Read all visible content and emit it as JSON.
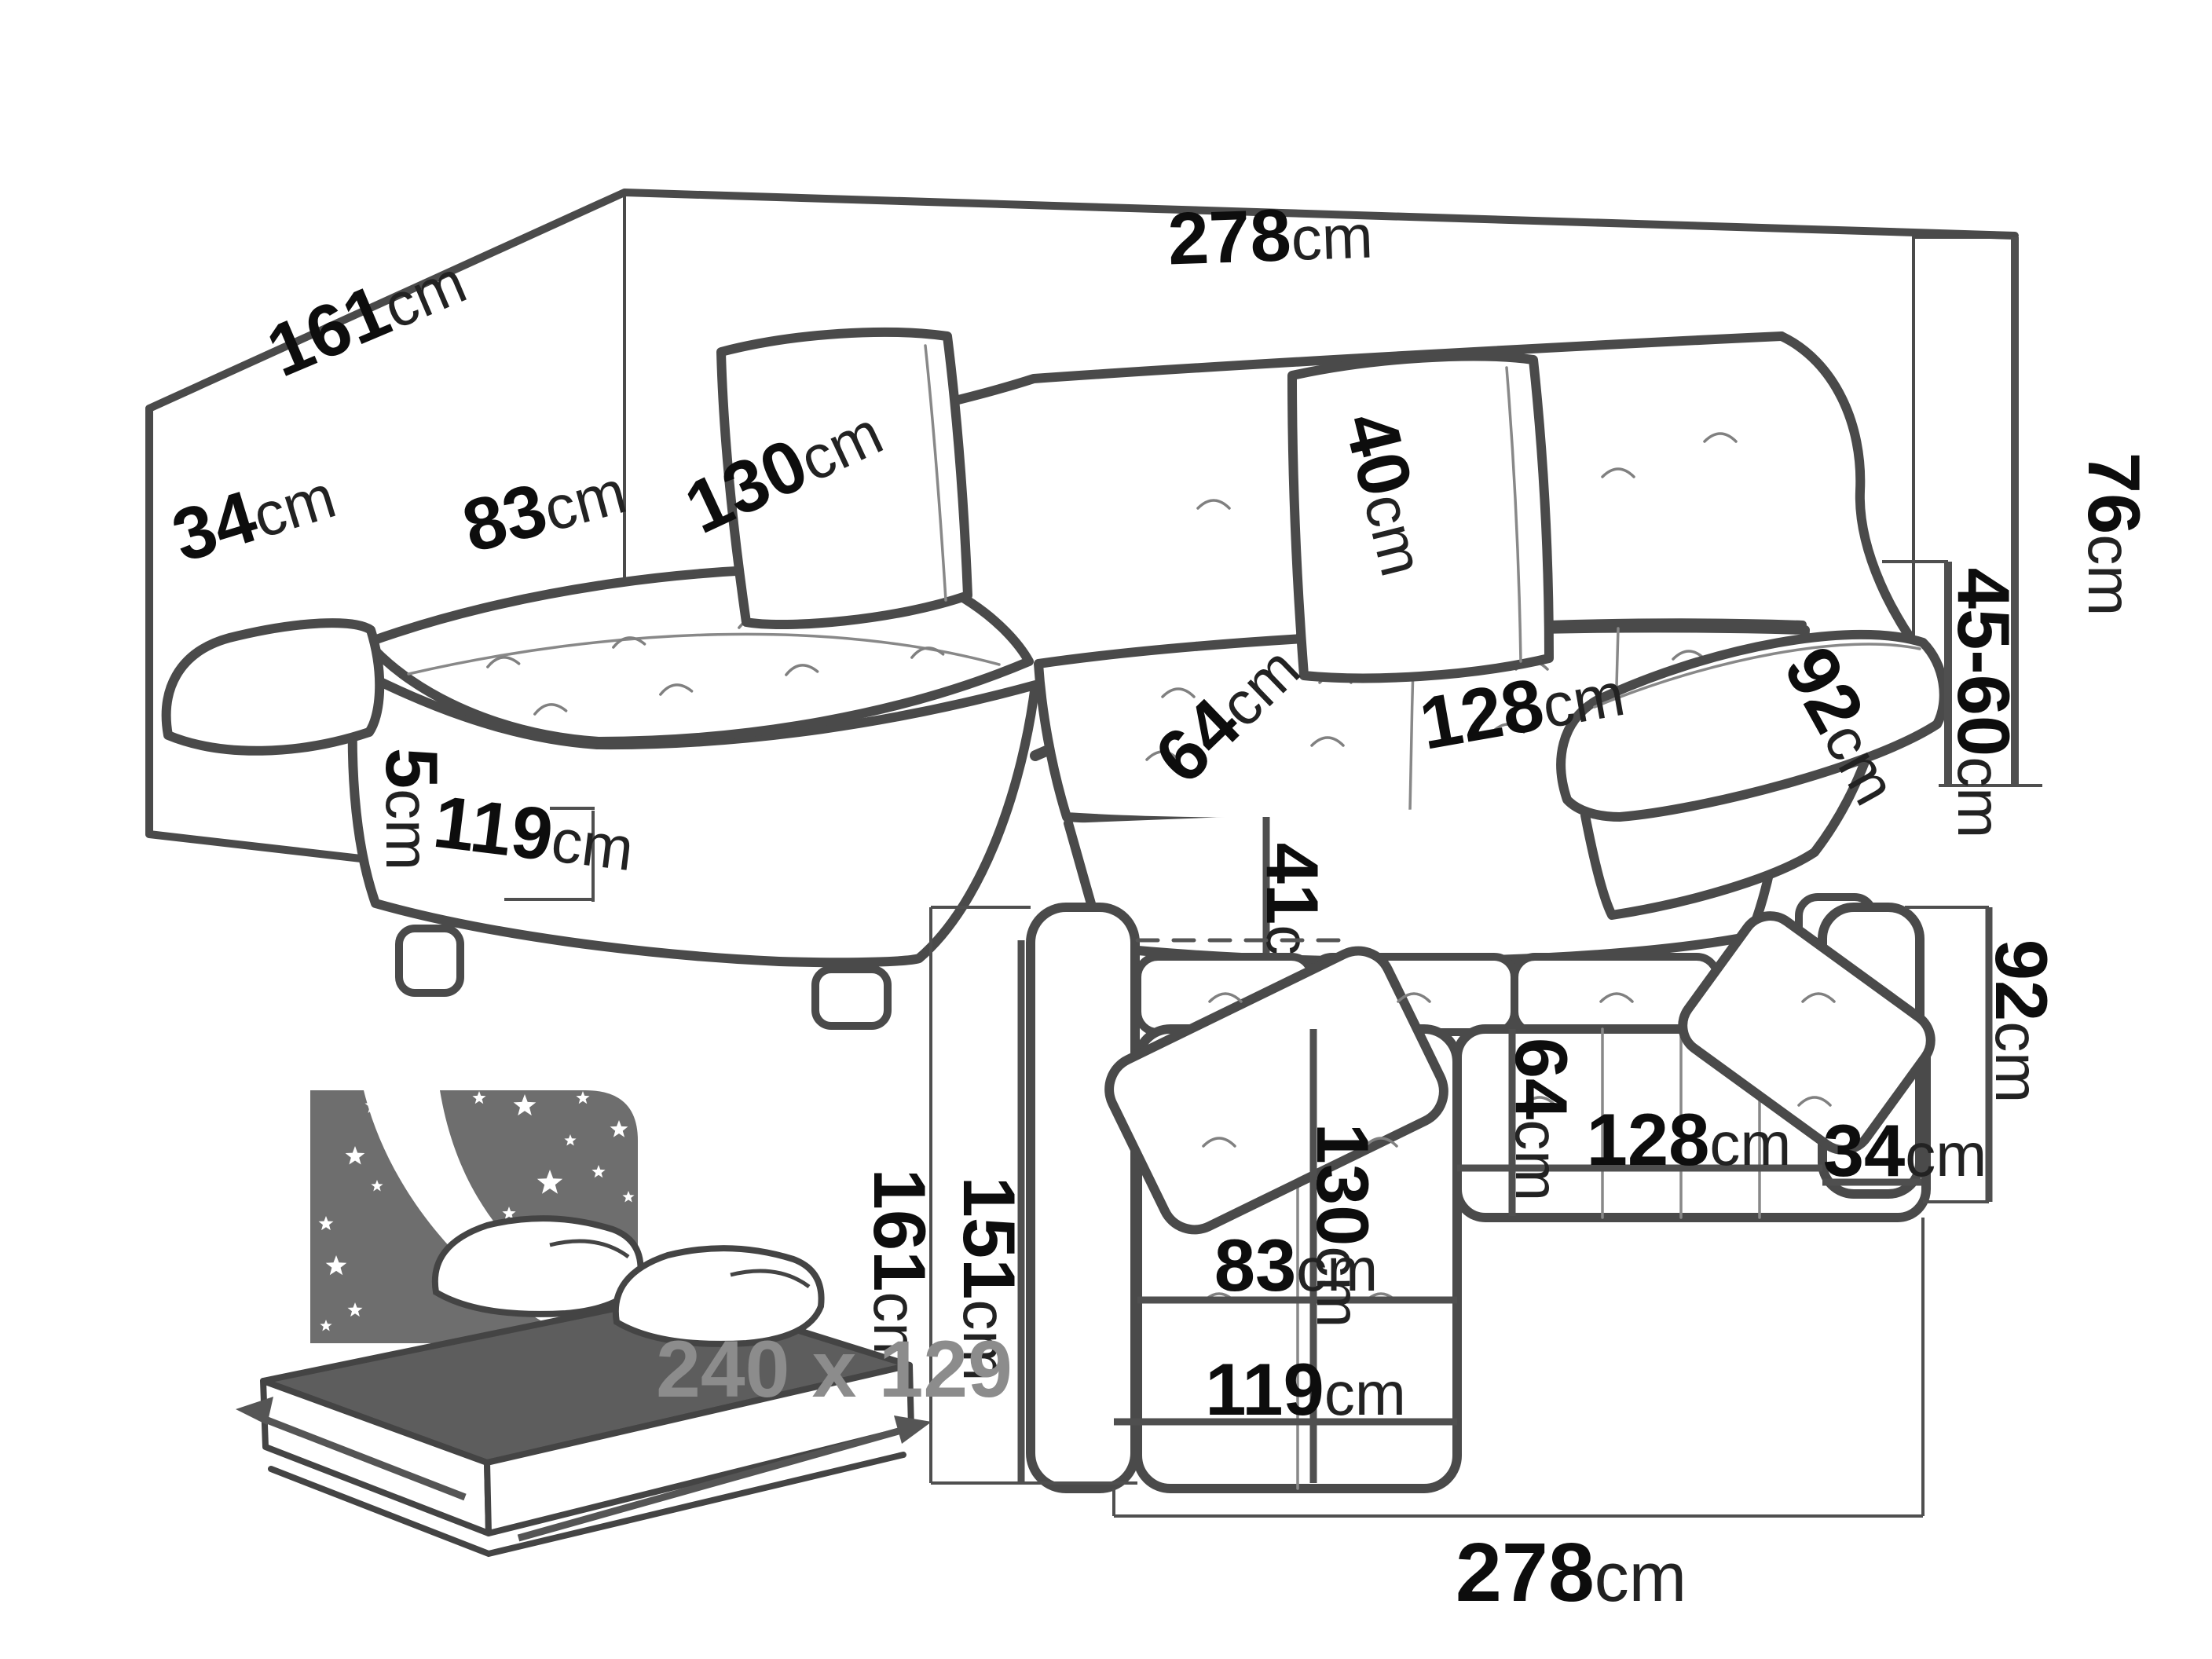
{
  "title": "Corner sofa dimensions diagram",
  "colors": {
    "line_art": "#4a4a4a",
    "dimension_lines": "#4f4f4f",
    "label_text": "#0d0d0d",
    "icon_gray": "#6e6e6e",
    "bed_top_gray": "#5d5d5d",
    "bed_size_text": "#8c8c8c",
    "background": "#ffffff"
  },
  "perspective_view": {
    "name": "perspective view of corner sofa",
    "dimensions": {
      "side_depth": {
        "value": "161",
        "unit": "cm"
      },
      "back_width": {
        "value": "278",
        "unit": "cm"
      },
      "left_armrest_width": {
        "value": "34",
        "unit": "cm"
      },
      "chaise_seat_width": {
        "value": "83",
        "unit": "cm"
      },
      "chaise_seat_length": {
        "value": "130",
        "unit": "cm"
      },
      "backrest_height": {
        "value": "40",
        "unit": "cm"
      },
      "seat_depth": {
        "value": "64",
        "unit": "cm"
      },
      "seat_width": {
        "value": "128",
        "unit": "cm"
      },
      "right_armrest_length": {
        "value": "92",
        "unit": "cm"
      },
      "total_height": {
        "value": "76",
        "unit": "cm"
      },
      "armrest_height": {
        "value": "45-60",
        "unit": "cm"
      },
      "seat_height": {
        "value": "41",
        "unit": "cm"
      },
      "leg_height": {
        "value": "5",
        "unit": "cm"
      },
      "chaise_front_depth": {
        "value": "119",
        "unit": "cm"
      }
    }
  },
  "top_view": {
    "name": "top-down plan view of corner sofa",
    "dimensions": {
      "total_depth": {
        "value": "161",
        "unit": "cm"
      },
      "body_depth": {
        "value": "151",
        "unit": "cm"
      },
      "chaise_length": {
        "value": "130",
        "unit": "cm"
      },
      "seat_depth": {
        "value": "64",
        "unit": "cm"
      },
      "chaise_seat_width": {
        "value": "83",
        "unit": "cm"
      },
      "seat_width": {
        "value": "128",
        "unit": "cm"
      },
      "right_armrest_width": {
        "value": "34",
        "unit": "cm"
      },
      "right_armrest_depth": {
        "value": "92",
        "unit": "cm"
      },
      "chaise_width": {
        "value": "119",
        "unit": "cm"
      },
      "total_width": {
        "value": "278",
        "unit": "cm"
      }
    }
  },
  "sleeping_function": {
    "icon": "sofa-bed-night-sleeping-icon",
    "bed_size": "240 x 129"
  }
}
